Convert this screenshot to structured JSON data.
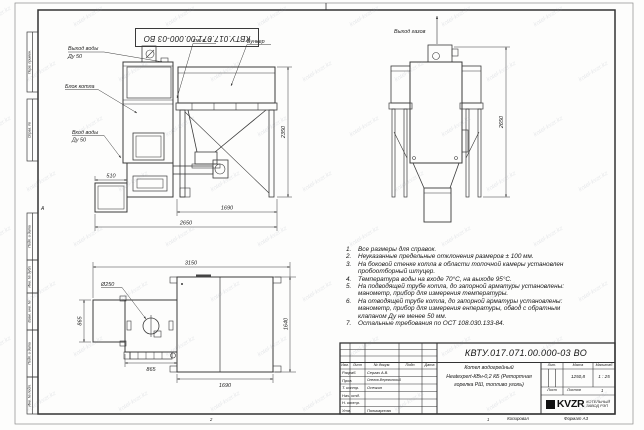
{
  "frame": {
    "doc_number_rotated": "КВТУ.017.071.00.000-03 ВО",
    "zone_row_label": "А",
    "zone_col_labels": [
      "2",
      "1"
    ],
    "side_labels": [
      "Перв. примен.",
      "Справ. №",
      "Подп. и дата",
      "Инв. № дубл.",
      "Взам. инв. №",
      "Подп. и дата",
      "Инв. № подл."
    ]
  },
  "views": {
    "front": {
      "labels": {
        "water_out_1": "Выход воды",
        "water_out_2": "Ду 50",
        "boiler_block": "Блок котла",
        "water_in_1": "Вход воды",
        "water_in_2": "Ду 50",
        "see_note": "см. п. 3",
        "bunker": "Бункер"
      },
      "dims": {
        "d510": "510",
        "d1690": "1690",
        "d2650": "2650",
        "d2350": "2350"
      }
    },
    "side": {
      "labels": {
        "gas_out": "Выход газов"
      },
      "dims": {
        "d2650": "2650"
      }
    },
    "plan": {
      "labels": {
        "d250": "Ø250"
      },
      "dims": {
        "d3150": "3150",
        "d1640": "1640",
        "d865l": "865",
        "d865b": "865",
        "d1690": "1690"
      }
    }
  },
  "notes": {
    "items": [
      {
        "num": "1.",
        "text": "Все размеры для справок."
      },
      {
        "num": "2.",
        "text": "Неуказанные предельные отклонения размеров ± 100 мм."
      },
      {
        "num": "3.",
        "text": "На боковой стенке котла в области топочной камеры установлен пробоотборный штуцер."
      },
      {
        "num": "4.",
        "text": "Температура воды на входе 70°С, на выходе 95°С."
      },
      {
        "num": "5.",
        "text": "На подводящей трубе котла, до запорной арматуры установлены: манометр, прибор для измерения температуры."
      },
      {
        "num": "6.",
        "text": "На отводящей трубе котла, до запорной арматуры установлены: манометр, прибор для измерения енпературы, обвод с обратным клапаном Ду не менее 50 мм."
      },
      {
        "num": "7.",
        "text": "Остальные требования по ОСТ 108.030.133-84."
      }
    ]
  },
  "title_block": {
    "doc_number": "КВТУ.017.071.00.000-03 ВО",
    "product_name": [
      "Котел водогрейный",
      "Heatexpert-КВн-0,2 КБ (Ретортная",
      "горелка РШ, топливо уголь)"
    ],
    "headers": {
      "izm": "Изм.",
      "list": "Лист",
      "dokum": "№ докум.",
      "podp": "Подп.",
      "data": "Дата",
      "lit": "Лит.",
      "massa": "Масса",
      "masshtab": "Масштаб",
      "list2": "Лист",
      "listov": "Листов"
    },
    "rows": [
      {
        "role": "Разраб.",
        "name": "Сергач А.В."
      },
      {
        "role": "Пров.",
        "name": "Онегов-Вережинский"
      },
      {
        "role": "Т. контр.",
        "name": "Осечкин"
      },
      {
        "role": "Нач. отд.",
        "name": ""
      },
      {
        "role": "Н. контр.",
        "name": ""
      },
      {
        "role": "Утв.",
        "name": "Поликарпова"
      }
    ],
    "massa_value": "1250,8",
    "masshtab_value": "1 : 25",
    "listov_value": "1",
    "logo": {
      "brand": "KVZR",
      "sub1": "КОТЕЛЬНЫЙ",
      "sub2": "ЗАВОД РЭП"
    }
  },
  "footer": {
    "kopiroval": "Копировал",
    "format": "Формат А3"
  },
  "watermark": {
    "text": "kotel-kvzr.kz"
  }
}
